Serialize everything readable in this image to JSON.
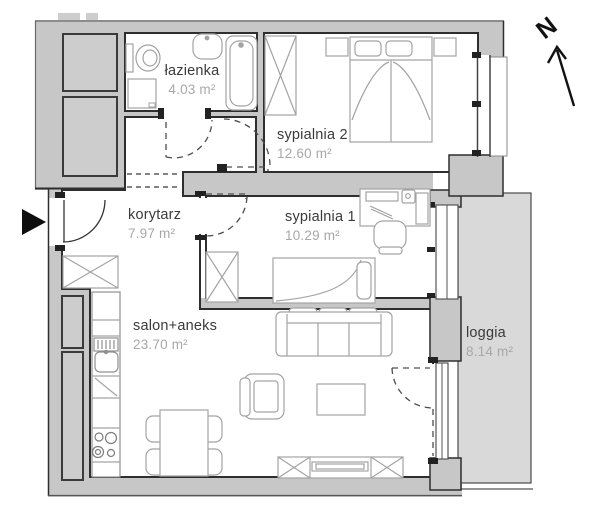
{
  "plan": {
    "rooms": [
      {
        "id": "lazienka",
        "name": "łazienka",
        "area": "4.03 m²"
      },
      {
        "id": "sypialnia2",
        "name": "sypialnia 2",
        "area": "12.60 m²"
      },
      {
        "id": "korytarz",
        "name": "korytarz",
        "area": "7.97 m²"
      },
      {
        "id": "sypialnia1",
        "name": "sypialnia 1",
        "area": "10.29 m²"
      },
      {
        "id": "salon",
        "name": "salon+aneks",
        "area": "23.70 m²"
      },
      {
        "id": "loggia",
        "name": "loggia",
        "area": "8.14 m²"
      }
    ],
    "compass": {
      "label": "N"
    },
    "icons": {
      "entrance": "black-triangle-right-arrow",
      "compass": "north-arrow"
    },
    "colors": {
      "wall_fill": "#c7c7c7",
      "wall_edge": "#2e2e2e",
      "shaft_fill": "#cdcdcd",
      "loggia_fill": "#d9d9d9",
      "furniture_line": "#a6a6a6",
      "room_name_text": "#3a3a3a",
      "area_text": "#a8a8a8",
      "arrow": "#111111"
    }
  }
}
